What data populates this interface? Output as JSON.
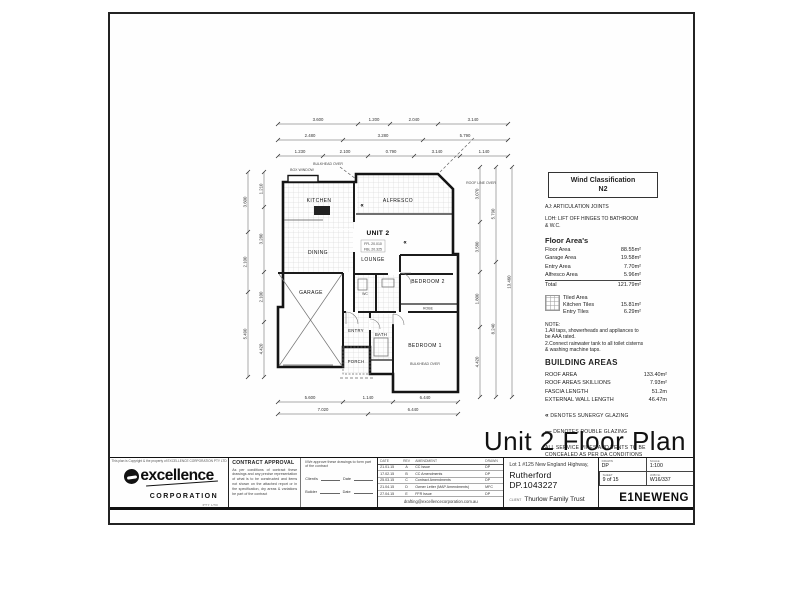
{
  "page_title": "Unit 2 Floor Plan",
  "wind_box": {
    "line1": "Wind Classification",
    "line2": "N2"
  },
  "notes_top": {
    "aj": "AJ: ARTICULATION JOINTS",
    "loh": "LOH: LIFT OFF HINGES TO BATHROOM & W.C."
  },
  "floor_areas": {
    "heading": "Floor Area's",
    "rows": [
      {
        "label": "Floor Area",
        "value": "88.55m²"
      },
      {
        "label": "Garage Area",
        "value": "19.58m²"
      },
      {
        "label": "Entry Area",
        "value": "7.70m²"
      },
      {
        "label": "Alfresco Area",
        "value": "5.96m²"
      },
      {
        "label": "Total",
        "value": "121.79m²"
      }
    ]
  },
  "tiled": {
    "title": "Tiled Area",
    "rows": [
      {
        "label": "Kitchen Tiles",
        "value": "15.81m²"
      },
      {
        "label": "Entry Tiles",
        "value": "6.29m²"
      }
    ]
  },
  "note": {
    "heading": "NOTE:",
    "lines": [
      "1.All taps, showerheads and appliances to be AAA rated.",
      "2.Connect rainwater tank to all toilet cisterns & washing machine taps."
    ]
  },
  "building_areas": {
    "heading": "BUILDING AREAS",
    "rows": [
      {
        "label": "ROOF AREA",
        "value": "133.40m²"
      },
      {
        "label": "ROOF AREAS SKILLIONS",
        "value": "7.93m²"
      },
      {
        "label": "FASCIA LENGTH",
        "value": "51.2m"
      },
      {
        "label": "EXTERNAL WALL LENGTH",
        "value": "46.47m"
      }
    ]
  },
  "glazing": {
    "sunergy_symbol": "«",
    "sunergy": "DENOTES SUNERGY GLAZING",
    "double_symbol": "—",
    "double": "DENOTES DOUBLE GLAZING"
  },
  "services_note": "ALL SERVICE PIPES AND VENTS TO BE CONCEALED AS PER DA CONDITIONS",
  "plan": {
    "unit": "UNIT 2",
    "rooms": {
      "kitchen": "KITCHEN",
      "alfresco": "ALFRESCO",
      "dining": "DINING",
      "lounge": "LOUNGE",
      "garage": "GARAGE",
      "entry": "ENTRY",
      "porch": "PORCH",
      "bath": "BATH",
      "wc": "WC",
      "bed1": "BEDROOM 1",
      "bed2": "BEDROOM 2",
      "robe": "ROBE"
    },
    "annotations": {
      "ffl": "FFL 20.010",
      "fbl": "FBL 20.325",
      "bulkhead": "BULKHEAD OVER",
      "bulkhead2": "BULKHEAD OVER",
      "roofline": "ROOF LINE OVER",
      "boxwindow": "BOX WINDOW",
      "glaze": "«"
    },
    "dims": {
      "top_a": [
        "3.600",
        "1.200",
        "2.040",
        "3.140"
      ],
      "top_b": [
        "2.480",
        "3.280",
        "5.790"
      ],
      "top_c": [
        "1.230",
        "2.100",
        "0.790",
        "3.140",
        "1.140"
      ],
      "left_a": [
        "3.600",
        "2.100",
        "5.490"
      ],
      "left_b": [
        "1.210",
        "3.280",
        "2.100",
        "4.420"
      ],
      "right_a": [
        "3.070",
        "3.580",
        "1.800",
        "4.420"
      ],
      "right_b": [
        "5.790",
        "8.240"
      ],
      "right_c": [
        "13.460"
      ],
      "bottom_a": [
        "5.600",
        "1.140",
        "6.440"
      ],
      "bottom_b": [
        "7.020",
        "6.440"
      ]
    }
  },
  "titleblock": {
    "copyright": "This plan is Copyright & the property of EXCELLENCE CORPORATION PTY LTD",
    "logo": {
      "name": "excellence",
      "sub": "CORPORATION",
      "pty": "PTY LTD"
    },
    "contract": {
      "heading": "CONTRACT APPROVAL",
      "body": "As per conditions of contract these drawings and any precise representation of what is to be constructed and items not shown on the attached report or in the specification, dry areas & variations be part of the contract",
      "approve": "I/We approve these drawings to form part of the contract",
      "client_label": "Client/s",
      "builder_label": "Builder",
      "date_label": "Date"
    },
    "revisions": {
      "headers": [
        "DATE",
        "REV",
        "AMENDMENT",
        "DRAWN"
      ],
      "rows": [
        [
          "21.01.15",
          "A",
          "CC Issue",
          "DP"
        ],
        [
          "17.02.15",
          "B",
          "CC Amendments",
          "DP"
        ],
        [
          "25.03.15",
          "C",
          "Contract Amendments",
          "DP"
        ],
        [
          "21.04.15",
          "D",
          "Owner Letter (MAP Amendments)",
          "MFC"
        ],
        [
          "27.04.15",
          "E",
          "FFR Issue",
          "DP"
        ]
      ],
      "email": "drafting@excellencecorporation.com.au"
    },
    "project": {
      "address_line1": "Lot 1 #125 New England Highway,",
      "address_line2": "Rutherford DP.1043227",
      "client_label": "CLIENT",
      "client": "Thurlow Family Trust"
    },
    "meta": {
      "drawn_label": "DRAWN",
      "drawn": "DP",
      "scale_label": "SCALE",
      "scale": "1:100",
      "sheet_label": "SHEET",
      "sheet": "9 of 15",
      "job_label": "JOB No",
      "job": "W16/337",
      "code": "E1NEWENG"
    }
  }
}
